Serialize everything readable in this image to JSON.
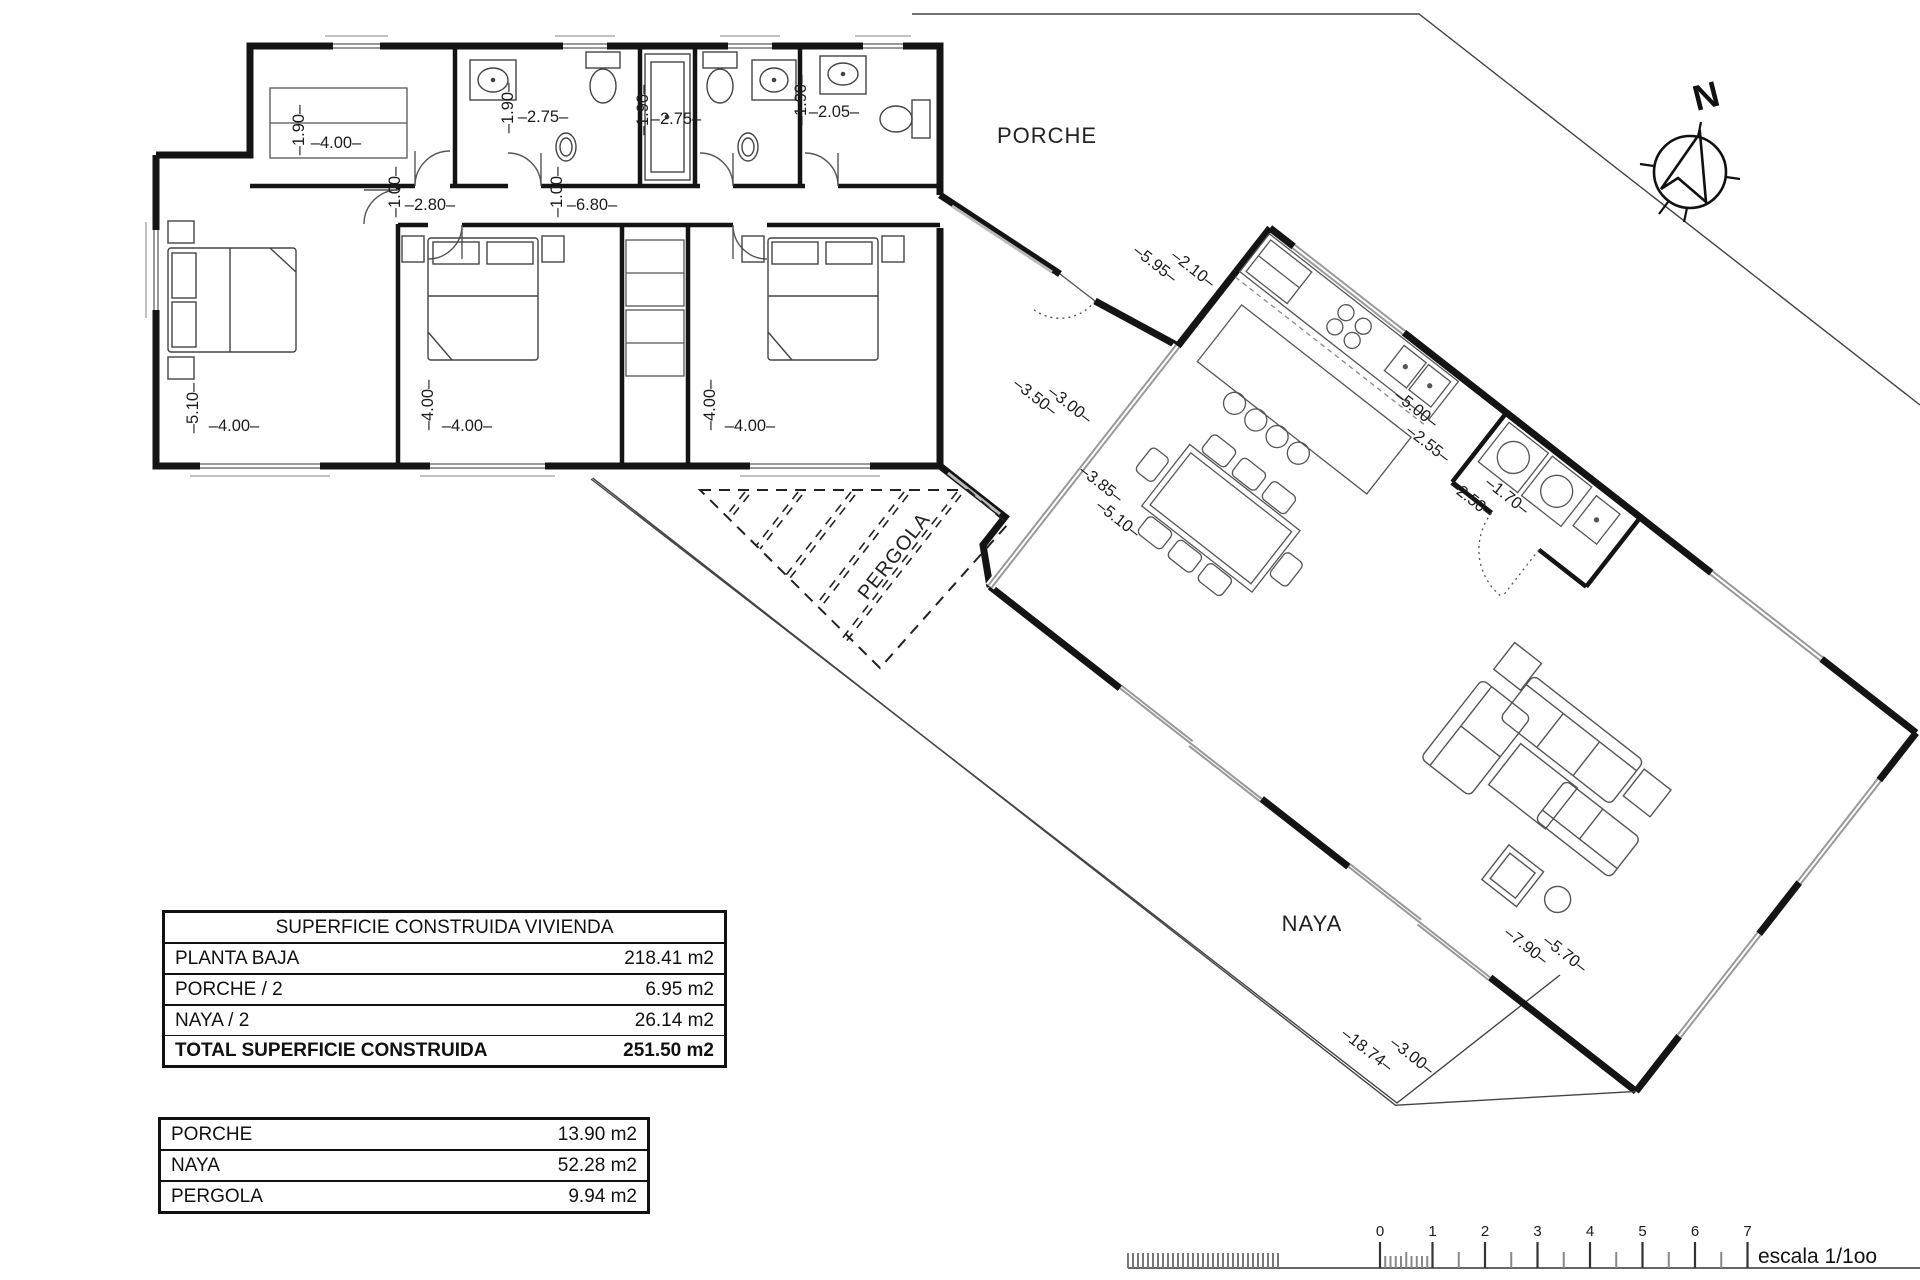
{
  "tables": {
    "vivienda": {
      "title": "SUPERFICIE CONSTRUIDA VIVIENDA",
      "rows": [
        {
          "label": "PLANTA BAJA",
          "value": "218.41 m2"
        },
        {
          "label": "PORCHE / 2",
          "value": "6.95 m2"
        },
        {
          "label": "NAYA / 2",
          "value": "26.14 m2"
        }
      ],
      "total": {
        "label": "TOTAL SUPERFICIE CONSTRUIDA",
        "value": "251.50 m2"
      }
    },
    "exterior": {
      "rows": [
        {
          "label": "PORCHE",
          "value": "13.90 m2"
        },
        {
          "label": "NAYA",
          "value": "52.28 m2"
        },
        {
          "label": "PERGOLA",
          "value": "9.94 m2"
        }
      ]
    }
  },
  "scale_bar": {
    "ticks": [
      "0",
      "1",
      "2",
      "3",
      "4",
      "5",
      "6",
      "7"
    ],
    "label": "escala 1/1oo"
  },
  "compass": {
    "label": "N"
  },
  "plan": {
    "room_labels": [
      {
        "text": "PORCHE",
        "x": 1047,
        "y": 143,
        "rot": 0,
        "size": 22
      },
      {
        "text": "PERGOLA",
        "x": 899,
        "y": 560,
        "rot": -52,
        "size": 20
      },
      {
        "text": "NAYA",
        "x": 1312,
        "y": 931,
        "rot": 0,
        "size": 22
      }
    ],
    "dimensions": [
      {
        "text": "1.90",
        "x": 304,
        "y": 130,
        "rot": -90
      },
      {
        "text": "4.00",
        "x": 336,
        "y": 148,
        "rot": 0
      },
      {
        "text": "1.90",
        "x": 513,
        "y": 108,
        "rot": -90
      },
      {
        "text": "2.75",
        "x": 543,
        "y": 122,
        "rot": 0
      },
      {
        "text": "1.90",
        "x": 648,
        "y": 110,
        "rot": -90
      },
      {
        "text": "2.75",
        "x": 676,
        "y": 124,
        "rot": 0
      },
      {
        "text": "1.90",
        "x": 806,
        "y": 100,
        "rot": -90
      },
      {
        "text": "2.05",
        "x": 834,
        "y": 117,
        "rot": 0
      },
      {
        "text": "1.00",
        "x": 400,
        "y": 192,
        "rot": -90
      },
      {
        "text": "2.80",
        "x": 430,
        "y": 210,
        "rot": 0
      },
      {
        "text": "1.00",
        "x": 562,
        "y": 192,
        "rot": -90
      },
      {
        "text": "6.80",
        "x": 592,
        "y": 210,
        "rot": 0
      },
      {
        "text": "5.10",
        "x": 198,
        "y": 408,
        "rot": -90
      },
      {
        "text": "4.00",
        "x": 234,
        "y": 431,
        "rot": 0
      },
      {
        "text": "4.00",
        "x": 433,
        "y": 405,
        "rot": -90
      },
      {
        "text": "4.00",
        "x": 467,
        "y": 431,
        "rot": 0
      },
      {
        "text": "4.00",
        "x": 715,
        "y": 405,
        "rot": -90
      },
      {
        "text": "4.00",
        "x": 750,
        "y": 431,
        "rot": 0
      },
      {
        "text": "5.95",
        "x": 1152,
        "y": 268,
        "rot": 38
      },
      {
        "text": "2.10",
        "x": 1190,
        "y": 273,
        "rot": 38
      },
      {
        "text": "3.50",
        "x": 1032,
        "y": 401,
        "rot": 38
      },
      {
        "text": "3.00",
        "x": 1067,
        "y": 409,
        "rot": 38
      },
      {
        "text": "3.85",
        "x": 1098,
        "y": 488,
        "rot": 38
      },
      {
        "text": "5.10",
        "x": 1115,
        "y": 523,
        "rot": 38
      },
      {
        "text": "5.00",
        "x": 1413,
        "y": 413,
        "rot": 38
      },
      {
        "text": "2.55",
        "x": 1425,
        "y": 448,
        "rot": 38
      },
      {
        "text": "2.50",
        "x": 1468,
        "y": 503,
        "rot": 38
      },
      {
        "text": "1.70",
        "x": 1504,
        "y": 500,
        "rot": 38
      },
      {
        "text": "7.90",
        "x": 1523,
        "y": 950,
        "rot": 38
      },
      {
        "text": "5.70",
        "x": 1562,
        "y": 958,
        "rot": 38
      },
      {
        "text": "18.74",
        "x": 1364,
        "y": 1054,
        "rot": 38
      },
      {
        "text": "3.00",
        "x": 1409,
        "y": 1060,
        "rot": 38
      }
    ]
  }
}
